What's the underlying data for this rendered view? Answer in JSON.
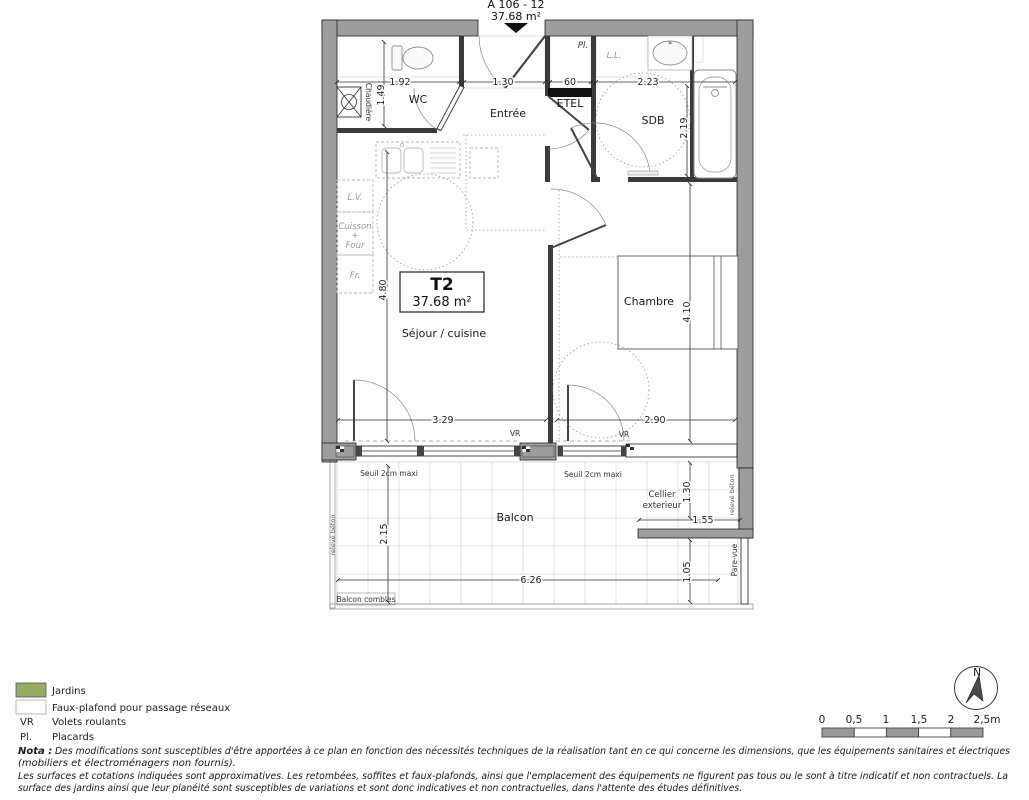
{
  "title": {
    "unit": "A 106 - 12",
    "area": "37.68 m²"
  },
  "plan": {
    "type_box": {
      "type": "T2",
      "area": "37.68 m²"
    },
    "rooms": {
      "wc": "WC",
      "entree": "Entrée",
      "etel": "ETEL",
      "sdb": "SDB",
      "sejour": "Séjour / cuisine",
      "chambre": "Chambre",
      "balcon": "Balcon",
      "cellier_line1": "Cellier",
      "cellier_line2": "exterieur"
    },
    "fixtures": {
      "chaudiere": "Chaudière",
      "lv": "L.V.",
      "cuisson": "Cuisson",
      "plus": "+",
      "four": "Four",
      "fr": "Fr.",
      "pl": "Pl.",
      "ll": "L.L."
    },
    "dims": {
      "wc_w": "1.92",
      "entree_w": "1.30",
      "etel_w": "60",
      "sdb_w": "2.23",
      "wc_h": "1.49",
      "sdb_h": "2.19",
      "sejour_h": "4.80",
      "sejour_w": "3.29",
      "chambre_w": "2.90",
      "chambre_h": "4.10",
      "balcon_h": "2.15",
      "balcon_w": "6.26",
      "cellier_h": "1.30",
      "cellier_w": "1.55",
      "parevue_h": "1.05"
    },
    "annotations": {
      "vr_sejour": "VR",
      "vr_chambre": "VR",
      "seuil_left": "Seuil 2cm maxi",
      "seuil_right": "Seuil 2cm maxi",
      "balcon_combles": "Balcon combles",
      "releve_left": "relevé béton",
      "releve_right": "relevé béton",
      "pare_vue": "Pare-vue"
    }
  },
  "legend": {
    "jardins": "Jardins",
    "faux_plafond": "Faux-plafond pour passage réseaux",
    "vr_abbr": "VR",
    "vr_label": "Volets roulants",
    "pl_abbr": "Pl.",
    "pl_label": "Placards"
  },
  "nota": {
    "lead": "Nota :",
    "line1": "Des modifications sont susceptibles d'être apportées à ce plan en fonction des nécessités techniques de la réalisation tant en ce qui concerne les dimensions, que les équipements sanitaires et électriques",
    "line2": "(mobiliers et électroménagers non fournis).",
    "line3": "Les surfaces et cotations indiquées sont approximatives. Les retombées, soffites et faux-plafonds, ainsi que l'emplacement des équipements ne figurent pas tous ou le sont à titre indicatif et non contractuels. La",
    "line4": "surface des jardins ainsi que leur planéité sont susceptibles de variations et sont donc indicatives et non contractuelles, dans l'attente des études définitives."
  },
  "scale_bar": {
    "ticks": [
      "0",
      "0,5",
      "1",
      "1,5",
      "2",
      "2,5m"
    ]
  },
  "north": {
    "label": "N"
  },
  "colors": {
    "wall_gray": "#9d9d9d",
    "jardins_green": "#94ac62"
  }
}
